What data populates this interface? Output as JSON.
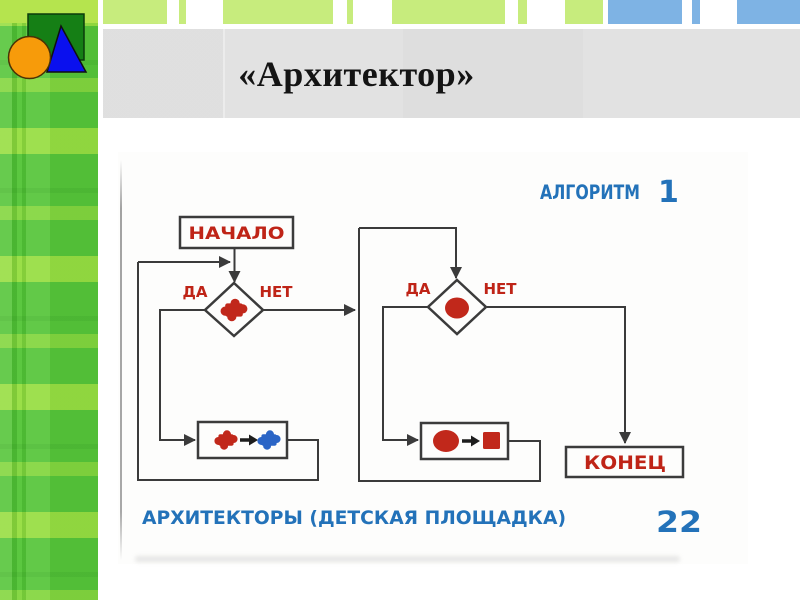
{
  "header": {
    "title": "«Архитектор»"
  },
  "logo": {
    "shapes": [
      "green-square-icon",
      "blue-triangle-icon",
      "orange-circle-icon"
    ],
    "square_color": "#157f15",
    "triangle_color": "#0a10ee",
    "circle_color": "#f79b0a"
  },
  "colors": {
    "sidebar_green": "#56c53a",
    "strip_green": "#c7ec7d",
    "strip_blue": "#7eb3e4",
    "title_bar_gray": "#e2e2e2",
    "line": "#3b3b3b",
    "accent_red": "#c1281b",
    "accent_blue_icon": "#2b65c6",
    "text_blue": "#2372b9",
    "text_red": "#bf2417"
  },
  "top_strips": [
    {
      "x": 103,
      "w": 64,
      "color": "strip_green"
    },
    {
      "x": 179,
      "w": 7,
      "color": "strip_green"
    },
    {
      "x": 223,
      "w": 110,
      "color": "strip_green"
    },
    {
      "x": 347,
      "w": 6,
      "color": "strip_green"
    },
    {
      "x": 392,
      "w": 113,
      "color": "strip_green"
    },
    {
      "x": 518,
      "w": 9,
      "color": "strip_green"
    },
    {
      "x": 565,
      "w": 38,
      "color": "strip_green"
    },
    {
      "x": 608,
      "w": 74,
      "color": "strip_blue"
    },
    {
      "x": 692,
      "w": 8,
      "color": "strip_blue"
    },
    {
      "x": 737,
      "w": 63,
      "color": "strip_blue"
    }
  ],
  "flowchart": {
    "heading": {
      "word": "АЛГОРИТМ",
      "number": "1"
    },
    "start_label": "НАЧАЛО",
    "end_label": "КОНЕЦ",
    "decision1": {
      "yes": "ДА",
      "no": "НЕТ",
      "symbol": "red-puzzle-icon"
    },
    "decision2": {
      "yes": "ДА",
      "no": "НЕТ",
      "symbol": "red-circle-icon"
    },
    "action1": {
      "from": "red-puzzle-icon",
      "to": "blue-puzzle-icon"
    },
    "action2": {
      "from": "red-circle-icon",
      "to": "red-square-icon"
    },
    "caption": "АРХИТЕКТОРЫ (ДЕТСКАЯ ПЛОЩАДКА)",
    "page_number": "22"
  }
}
